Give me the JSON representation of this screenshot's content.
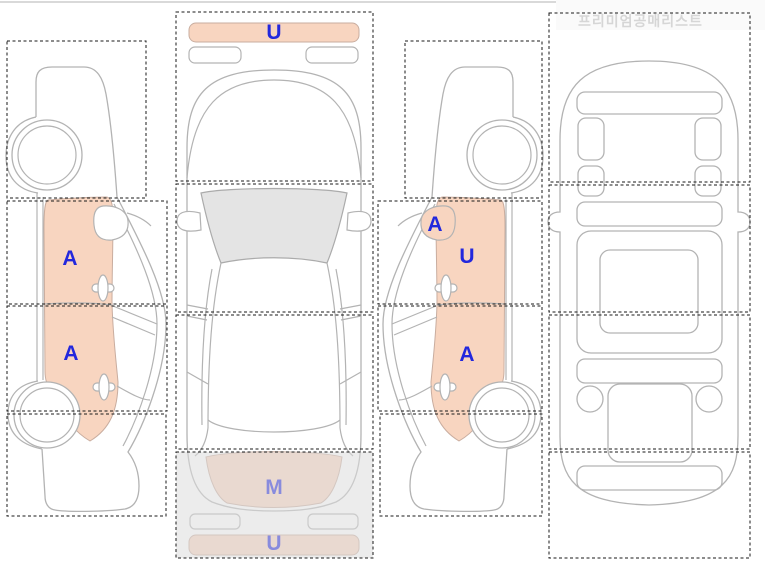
{
  "watermark": "프리미엄공매리스트",
  "colors": {
    "panel_highlight": "#f8d5c0",
    "panel_border": "#c9ad9f",
    "label_blue": "#2328dd",
    "line_gray": "#b3b3b3",
    "glass_gray": "#e4e4e4",
    "zone_dash": "#1a1a1a",
    "overlay_gray": "#dcdcdc",
    "watermark_gray": "#d6d6d6"
  },
  "views": {
    "left_side": {
      "title": "left-side-view",
      "front_door_code": "A",
      "rear_door_code": "A"
    },
    "top": {
      "title": "top-view",
      "front_bumper_code": "U",
      "trunk_code": "M",
      "rear_bumper_code": "U"
    },
    "right_side": {
      "title": "right-side-view",
      "mirror_code": "A",
      "front_door_code": "U",
      "rear_door_code": "A"
    },
    "bottom": {
      "title": "underbody-view"
    }
  }
}
